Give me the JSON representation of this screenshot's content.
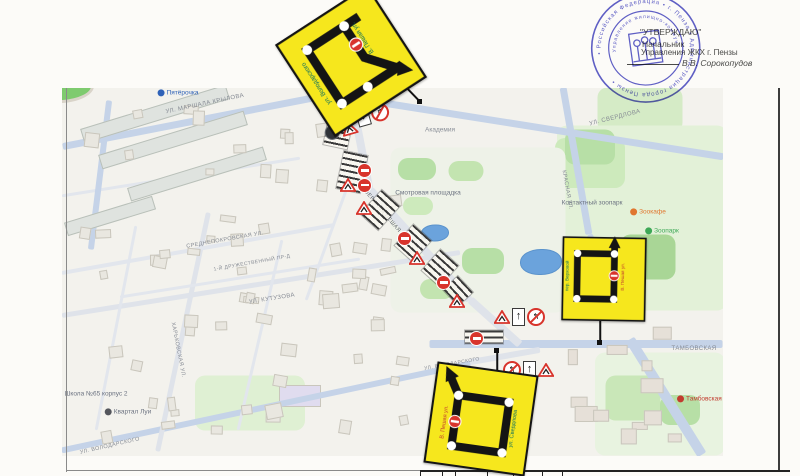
{
  "approval": {
    "line1": "\"УТВЕРЖДАЮ\"",
    "line2": "Начальник",
    "line3": "Управления ЖКХ г. Пензы",
    "line4": "В.В. Сорокопудов"
  },
  "stamp": {
    "outer_ring": "• Российская Федерация • г. Пенза • Администрация города Пензы •",
    "inner_ring": "Управление жилищно-коммунального хозяйства • ИНН 583601 •",
    "color": "#4040c0"
  },
  "map": {
    "street_labels": [
      {
        "text": "УЛ. МАРШАЛА КРЫЛОВА",
        "x": 205,
        "y": 104,
        "rot": -12,
        "size": 6,
        "color": "#868b94"
      },
      {
        "text": "УЛ. СВЕРДЛОВА",
        "x": 615,
        "y": 118,
        "rot": -14,
        "size": 6,
        "color": "#868b94"
      },
      {
        "text": "КРАСНАЯ УЛ.",
        "x": 567,
        "y": 190,
        "rot": 80,
        "size": 5.5,
        "color": "#868b94"
      },
      {
        "text": "ВЕРХНЯЯ ПЕШАЯ УЛ.",
        "x": 386,
        "y": 216,
        "rot": 50,
        "size": 5.5,
        "color": "#5f646d"
      },
      {
        "text": "СРЕДНЕПОКРОВСКАЯ УЛ.",
        "x": 225,
        "y": 240,
        "rot": -10,
        "size": 5.5,
        "color": "#868b94"
      },
      {
        "text": "1-Й ДРУЖЕСТВЕННЫЙ ПР-Д",
        "x": 252,
        "y": 263,
        "rot": -10,
        "size": 5,
        "color": "#868b94"
      },
      {
        "text": "УЛ. КУТУЗОВА",
        "x": 272,
        "y": 299,
        "rot": -9,
        "size": 6,
        "color": "#868b94"
      },
      {
        "text": "ХАРЬКОВСКАЯ УЛ.",
        "x": 178,
        "y": 350,
        "rot": 79,
        "size": 5.5,
        "color": "#868b94"
      },
      {
        "text": "УЛ. ВОЛОДАРСКОГО",
        "x": 110,
        "y": 446,
        "rot": -13,
        "size": 5.5,
        "color": "#868b94"
      },
      {
        "text": "УЛ. ВОЛОДАРСКОГО",
        "x": 452,
        "y": 364,
        "rot": -10,
        "size": 5,
        "color": "#868b94"
      },
      {
        "text": "ТАМБОВСКАЯ",
        "x": 694,
        "y": 349,
        "rot": 0,
        "size": 6,
        "color": "#868b94"
      }
    ],
    "pois": [
      {
        "text": "Пятёрочка",
        "x": 178,
        "y": 93,
        "color": "#2f62b8",
        "dot": "#2f62b8"
      },
      {
        "text": "Академия",
        "x": 440,
        "y": 130,
        "color": "#8a8f98",
        "dot": ""
      },
      {
        "text": "Смотровая площадка",
        "x": 428,
        "y": 193,
        "color": "#6b7280",
        "dot": ""
      },
      {
        "text": "Контактный зоопарк",
        "x": 592,
        "y": 203,
        "color": "#6b7280",
        "dot": ""
      },
      {
        "text": "Зоокафе",
        "x": 648,
        "y": 212,
        "color": "#e0762f",
        "dot": "#e0762f"
      },
      {
        "text": "Зоопарк",
        "x": 662,
        "y": 231,
        "color": "#3da856",
        "dot": "#3da856"
      },
      {
        "text": "Квартал Луи",
        "x": 128,
        "y": 412,
        "color": "#6b7280",
        "dot": "#54565c"
      },
      {
        "text": "Школа №65 корпус 2",
        "x": 96,
        "y": 394,
        "color": "#6b7280",
        "dot": ""
      },
      {
        "text": "Тамбовская застава",
        "x": 712,
        "y": 399,
        "color": "#c23b2f",
        "dot": "#c23b2f"
      }
    ]
  },
  "closures": [
    {
      "x": 338,
      "y": 133,
      "w": 24,
      "h": 28,
      "rot": 12
    },
    {
      "x": 352,
      "y": 172,
      "w": 24,
      "h": 38,
      "rot": 12
    },
    {
      "x": 380,
      "y": 210,
      "w": 24,
      "h": 32,
      "rot": 42
    },
    {
      "x": 413,
      "y": 243,
      "w": 24,
      "h": 28,
      "rot": 42
    },
    {
      "x": 440,
      "y": 268,
      "w": 24,
      "h": 28,
      "rot": 42
    },
    {
      "x": 458,
      "y": 291,
      "w": 22,
      "h": 20,
      "rot": 47
    },
    {
      "x": 484,
      "y": 337,
      "w": 38,
      "h": 13,
      "rot": 0
    }
  ],
  "traffic": {
    "clusters": [
      {
        "x": 357,
        "y": 110,
        "rot": -16,
        "items": [
          "one_way_down",
          "no_right_turn"
        ]
      },
      {
        "x": 325,
        "y": 127,
        "rot": -16,
        "items": [
          "restriction_dark",
          "roadworks"
        ]
      },
      {
        "x": 358,
        "y": 164,
        "rot": 0,
        "items": [
          "no_entry"
        ]
      },
      {
        "x": 340,
        "y": 178,
        "rot": 0,
        "items": [
          "roadworks",
          "no_entry"
        ]
      },
      {
        "x": 356,
        "y": 201,
        "rot": 0,
        "items": [
          "roadworks"
        ]
      },
      {
        "x": 398,
        "y": 232,
        "rot": 0,
        "items": [
          "no_entry"
        ]
      },
      {
        "x": 409,
        "y": 251,
        "rot": 0,
        "items": [
          "roadworks"
        ]
      },
      {
        "x": 437,
        "y": 276,
        "rot": 0,
        "items": [
          "no_entry"
        ]
      },
      {
        "x": 449,
        "y": 294,
        "rot": 0,
        "items": [
          "roadworks"
        ]
      },
      {
        "x": 494,
        "y": 308,
        "rot": 0,
        "items": [
          "roadworks",
          "one_way_up",
          "no_left_turn"
        ]
      },
      {
        "x": 470,
        "y": 332,
        "rot": 0,
        "items": [
          "no_entry"
        ]
      },
      {
        "x": 503,
        "y": 361,
        "rot": 0,
        "items": [
          "no_left_turn",
          "one_way_up",
          "roadworks"
        ]
      }
    ]
  },
  "detour_signs": [
    {
      "id": "s1",
      "variant": 1,
      "label_left": "ул. Володарского",
      "label_inner": "В. Пешая ул.",
      "teal": "#0b6e5f",
      "red_label": "#c23b2f",
      "bg": "#f6e71d"
    },
    {
      "id": "s2",
      "variant": 2,
      "label_left": "пер. Верховой",
      "label_right": "В. Пешая ул.",
      "teal": "#0b6e5f",
      "red_label": "#c23b2f",
      "bg": "#f6e71d"
    },
    {
      "id": "s3",
      "variant": 3,
      "label_left": "В. Пешая ул.",
      "label_right": "ул. Свердлова",
      "teal": "#0b6e5f",
      "red_label": "#c23b2f",
      "bg": "#f6e71d"
    }
  ],
  "colors": {
    "road_main": "#c5d3e8",
    "road_minor": "#e2e6ed",
    "map_bg": "#f3f2ed",
    "no_entry_red": "#d8342c",
    "sign_yellow": "#f6e71d",
    "stamp_blue": "#4040c0"
  }
}
